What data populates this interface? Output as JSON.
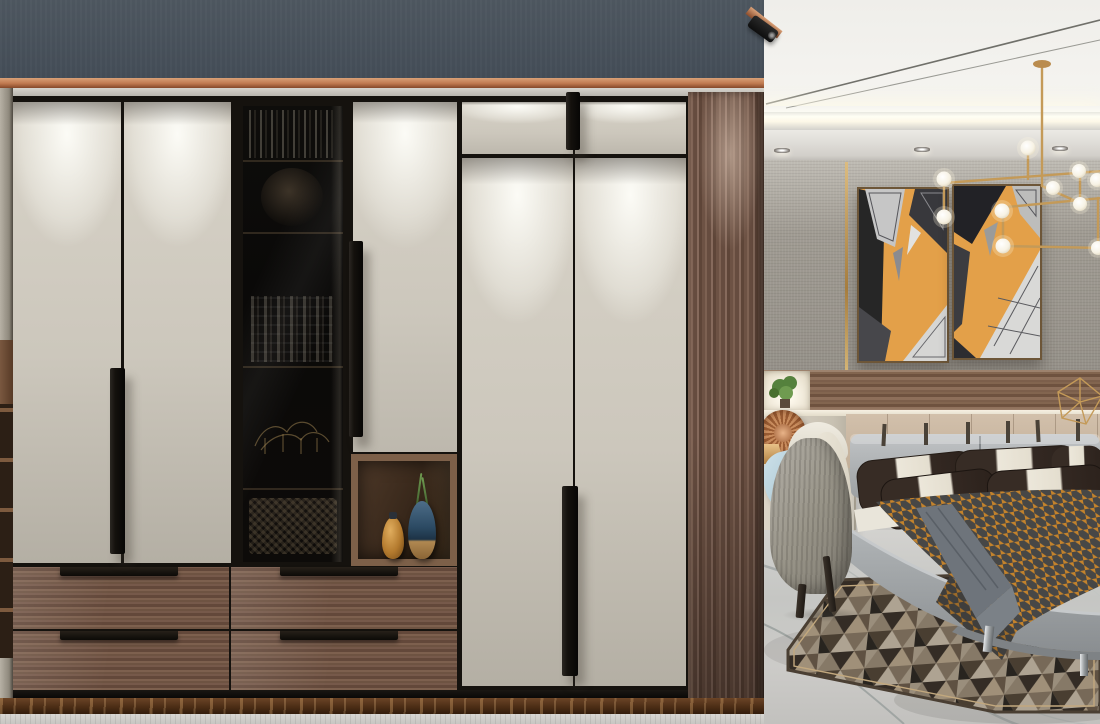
{
  "scene": {
    "label": "3D interior render: modern bedroom with floor-to-ceiling built-in wardrobe",
    "width_px": 1100,
    "height_px": 724
  },
  "palette": {
    "bulkhead_slate": "#49525C",
    "copper_trim": "#C07A50",
    "door_cream": "#D5D0C5",
    "frame_black": "#15120E",
    "walnut_wood": "#7A5C49",
    "smoked_glass": "#0C0B0A",
    "vase_amber": "#C08238",
    "vase_blue": "#2C4A63",
    "artwork_orange": "#E09A45",
    "throw_orange": "#C4832C",
    "throw_charcoal": "#3A4049",
    "pillow_espresso": "#372C25",
    "pillow_cream": "#ECE7DA",
    "chandelier_brass": "#C49A58",
    "marble_gray": "#C8C8C5",
    "plinth_brown_marble": "#53341D",
    "wallpaper_taupe": "#A6A198",
    "bed_gray": "#9FA3A5",
    "cushion_blue": "#BCD7E2"
  },
  "objects": {
    "bulkhead": {
      "label": "Slate-gray bulkhead band with copper trim above wardrobe"
    },
    "spotlight": {
      "label": "Black track spotlight at bulkhead corner"
    },
    "wardrobe": {
      "label": "Built-in wardrobe, cream lacquer doors with black vertical pull handles",
      "door_count": 7,
      "handle_count": 4
    },
    "display_cabinet": {
      "label": "Smoked-glass display cabinet with book shelves, sculpture and woven baskets"
    },
    "vase_niche": {
      "label": "Walnut display niche with amber gourd vase and blue glazed vase with green sprigs",
      "vase_count": 2
    },
    "drawers": {
      "label": "Walnut drawer bank with black bar pulls",
      "count": 4
    },
    "wood_column": {
      "label": "Walnut end column lit by spotlight"
    },
    "plinth": {
      "label": "Brown marble plinth strip under wardrobe"
    },
    "ceiling": {
      "label": "White tray ceiling with cove light and recessed downlights",
      "downlight_count": 3
    },
    "chandelier": {
      "label": "Brass branching chandelier with white globe bulbs",
      "bulb_count": 10
    },
    "artwork": {
      "label": "Two-panel print: skyscrapers seen from below against an orange sky",
      "panel_count": 2
    },
    "wallpaper": {
      "label": "Taupe woven-texture wallpaper with gold inlay strip"
    },
    "wood_band": {
      "label": "Horizontal walnut accent band on headboard wall"
    },
    "plant_niche": {
      "label": "Backlit wall niche with green plant"
    },
    "copper_fan": {
      "label": "Round woven copper wall decor"
    },
    "table_lamp": {
      "label": "Small brass table lamp"
    },
    "nightstand": {
      "label": "White bedside cabinet"
    },
    "chair": {
      "label": "High-back accent chair, gray shell with cream interior and light-blue cushion"
    },
    "bed": {
      "label": "Gray upholstered platform bed",
      "pillows": "espresso-and-cream striped pillows",
      "throw": "orange houndstooth throw with gray runner",
      "legs": "chrome feet"
    },
    "rug": {
      "label": "Geometric triangle-pattern area rug in browns and grays"
    },
    "floor": {
      "label": "Polished gray marble floor with veining"
    },
    "polyhedron": {
      "label": "Brass wireframe polyhedron decor on headboard ledge"
    }
  }
}
